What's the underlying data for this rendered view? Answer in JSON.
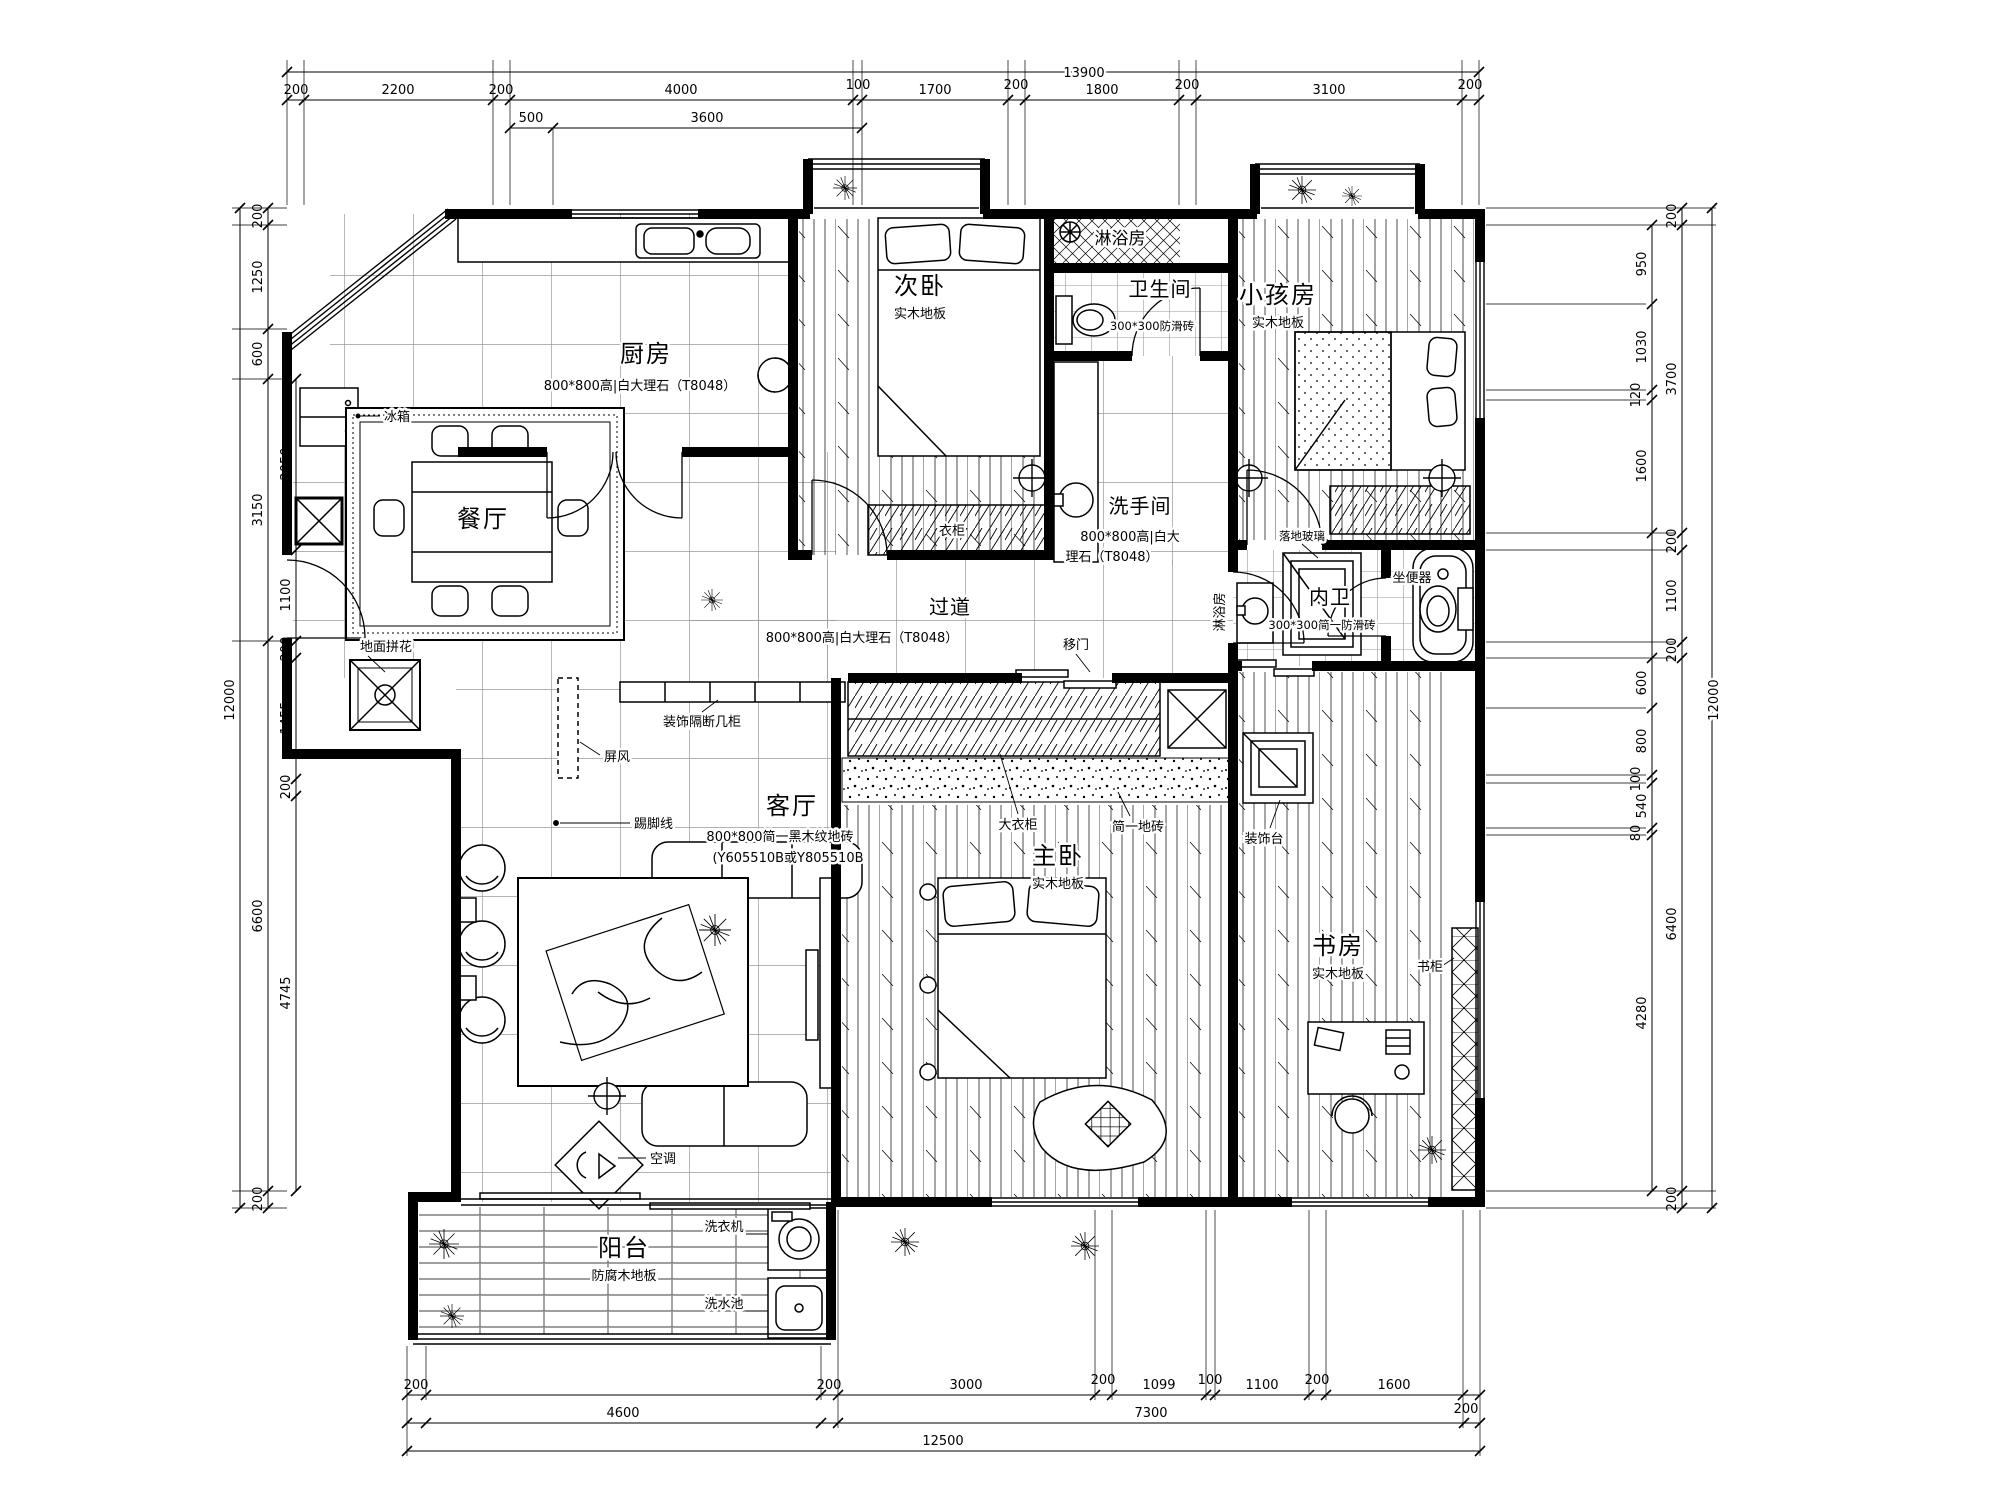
{
  "rooms": {
    "kitchen": {
      "name": "厨房",
      "note": "800*800高|白大理石（T8048）"
    },
    "dining": {
      "name": "餐厅"
    },
    "bedroom2": {
      "name": "次卧",
      "floor": "实木地板"
    },
    "shower_top": {
      "name": "淋浴房"
    },
    "bath": {
      "name": "卫生间",
      "note": "300*300防滑砖"
    },
    "washroom": {
      "name": "洗手间",
      "note1": "800*800高|白大",
      "note2": "理石（T8048）"
    },
    "kids": {
      "name": "小孩房",
      "floor": "实木地板"
    },
    "corridor": {
      "name": "过道",
      "note": "800*800高|白大理石（T8048）"
    },
    "master": {
      "name": "主卧",
      "floor": "实木地板"
    },
    "living": {
      "name": "客厅",
      "note1": "800*800简一黑木纹地砖",
      "note2": "(Y605510B或Y805510B"
    },
    "study": {
      "name": "书房",
      "floor": "实木地板"
    },
    "ensuite": {
      "name": "内卫",
      "note": "300*300简一防滑砖"
    },
    "balcony": {
      "name": "阳台",
      "floor": "防腐木地板"
    }
  },
  "labels": {
    "fridge": "冰箱",
    "slidingdoor": "移门",
    "closet": "衣柜",
    "shower2": "淋浴房",
    "glass": "落地玻璃",
    "toilet": "坐便器",
    "wardrobe": "大衣柜",
    "tile": "简一地砖",
    "console": "装饰台",
    "skirting": "踢脚线",
    "partition": "装饰隔断几柜",
    "screen": "屏风",
    "medallion": "地面拼花",
    "ac": "空调",
    "bookcase": "书柜",
    "washer": "洗衣机",
    "sink": "洗水池"
  },
  "dims": {
    "top": {
      "total": "13900",
      "segs": [
        "200",
        "2200",
        "200",
        "4000",
        "100",
        "1700",
        "200",
        "1800",
        "200",
        "3100",
        "200"
      ],
      "sub": [
        "500",
        "3600"
      ]
    },
    "left": {
      "total": "12000",
      "outer": [
        "200",
        "1250",
        "600",
        "3150",
        "6600",
        "200"
      ],
      "inner": [
        "2050",
        "1100",
        "200",
        "1455",
        "200",
        "4745"
      ]
    },
    "right": {
      "total": "12000",
      "outer": [
        "200",
        "3700",
        "200",
        "1100",
        "200",
        "6400",
        "200"
      ],
      "inner": [
        "950",
        "1030",
        "120",
        "1600",
        "600",
        "800",
        "100",
        "540",
        "80",
        "4280"
      ]
    },
    "bottom": {
      "total": "12500",
      "mid": [
        "4600",
        "7300"
      ],
      "segs": [
        "200",
        "200",
        "3000",
        "200",
        "1099",
        "100",
        "1100",
        "200",
        "1600",
        "200"
      ]
    }
  }
}
